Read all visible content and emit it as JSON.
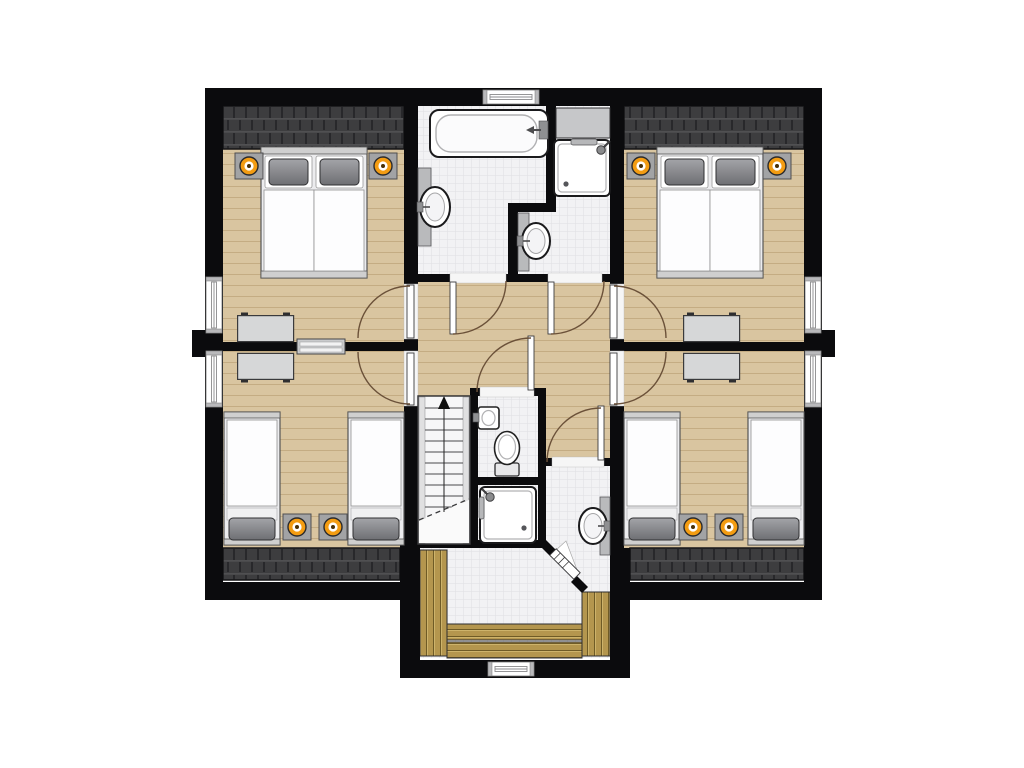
{
  "colors": {
    "wall": "#0b0b0d",
    "white": "#ffffff",
    "wood": "#d9c5a0",
    "wood_line": "#c4ac83",
    "tile_bg": "#f2f2f4",
    "tile_line": "#e1e1e5",
    "roof_base": "#3d3d3f",
    "roof_ridge": "#505052",
    "roof_dark": "#28282b",
    "deck": "#b4964e",
    "deck_line": "#6f5b26",
    "deck_light": "#cdb36b",
    "counter": "#b9babc",
    "furn_gray": "#d6d7d8",
    "stand_gray": "#a2a3a5",
    "frame_gray": "#cfcfcf",
    "lamp": "#f39c12",
    "pillow_top": "#a3a4a8",
    "pillow_bot": "#6e6f73",
    "fixture_outline": "#1a1a1c",
    "arc": "#6b5139",
    "stair_bg": "#f7f7f8"
  },
  "plan": {
    "type": "floor_plan",
    "shape": "rectangular upper floor with bottom-center dormer balcony landing",
    "rooms": [
      {
        "id": "bedroom-top-left",
        "floor": "wood",
        "items": [
          "double bed (2 mattresses, 2 gray pillows)",
          "nightstand with orange lamp x2",
          "desk",
          "roof hatch strip"
        ]
      },
      {
        "id": "bedroom-top-right",
        "floor": "wood",
        "items": [
          "double bed (2 mattresses, 2 gray pillows)",
          "nightstand with orange lamp x2",
          "desk",
          "roof hatch strip"
        ]
      },
      {
        "id": "bedroom-bottom-left",
        "floor": "wood",
        "items": [
          "single bed x2",
          "nightstand with orange lamp x2",
          "desk",
          "roof hatch strip"
        ]
      },
      {
        "id": "bedroom-bottom-right",
        "floor": "wood",
        "items": [
          "single bed x2",
          "nightstand with orange lamp x2",
          "desk",
          "roof hatch strip"
        ]
      },
      {
        "id": "bathroom-left",
        "floor": "tile",
        "items": [
          "bathtub with faucet",
          "pedestal washbasin",
          "window above tub"
        ]
      },
      {
        "id": "bathroom-right",
        "floor": "tile",
        "items": [
          "shower cabin",
          "pedestal washbasin",
          "gray storage block"
        ]
      },
      {
        "id": "wc",
        "floor": "tile",
        "items": [
          "hand basin",
          "toilet"
        ]
      },
      {
        "id": "shower-room",
        "floor": "tile",
        "items": [
          "shower tray with rail"
        ]
      },
      {
        "id": "rear-washroom",
        "floor": "tile",
        "items": [
          "pedestal washbasin"
        ]
      },
      {
        "id": "hallway",
        "floor": "wood",
        "items": [
          "staircase with up arrow",
          "side table bar on dividing wall"
        ]
      },
      {
        "id": "balcony-landing",
        "floor": "tile",
        "items": [
          "wood deck bench left",
          "wood deck bench right",
          "wood deck steps bottom x2",
          "diagonal glazed door",
          "window"
        ]
      }
    ],
    "counts": {
      "windows": 6,
      "swing_doors": 8,
      "diagonal_doors": 1,
      "beds": 6,
      "nightstand_lamps": 8,
      "desks": 4,
      "washbasins": 4,
      "toilets": 1,
      "bathtubs": 1,
      "showers": 2,
      "roof_hatch_areas": 4,
      "exterior_piers": 2
    },
    "stairs": {
      "direction": "up",
      "arrow": "north",
      "break_line": "dashed diagonal"
    }
  }
}
